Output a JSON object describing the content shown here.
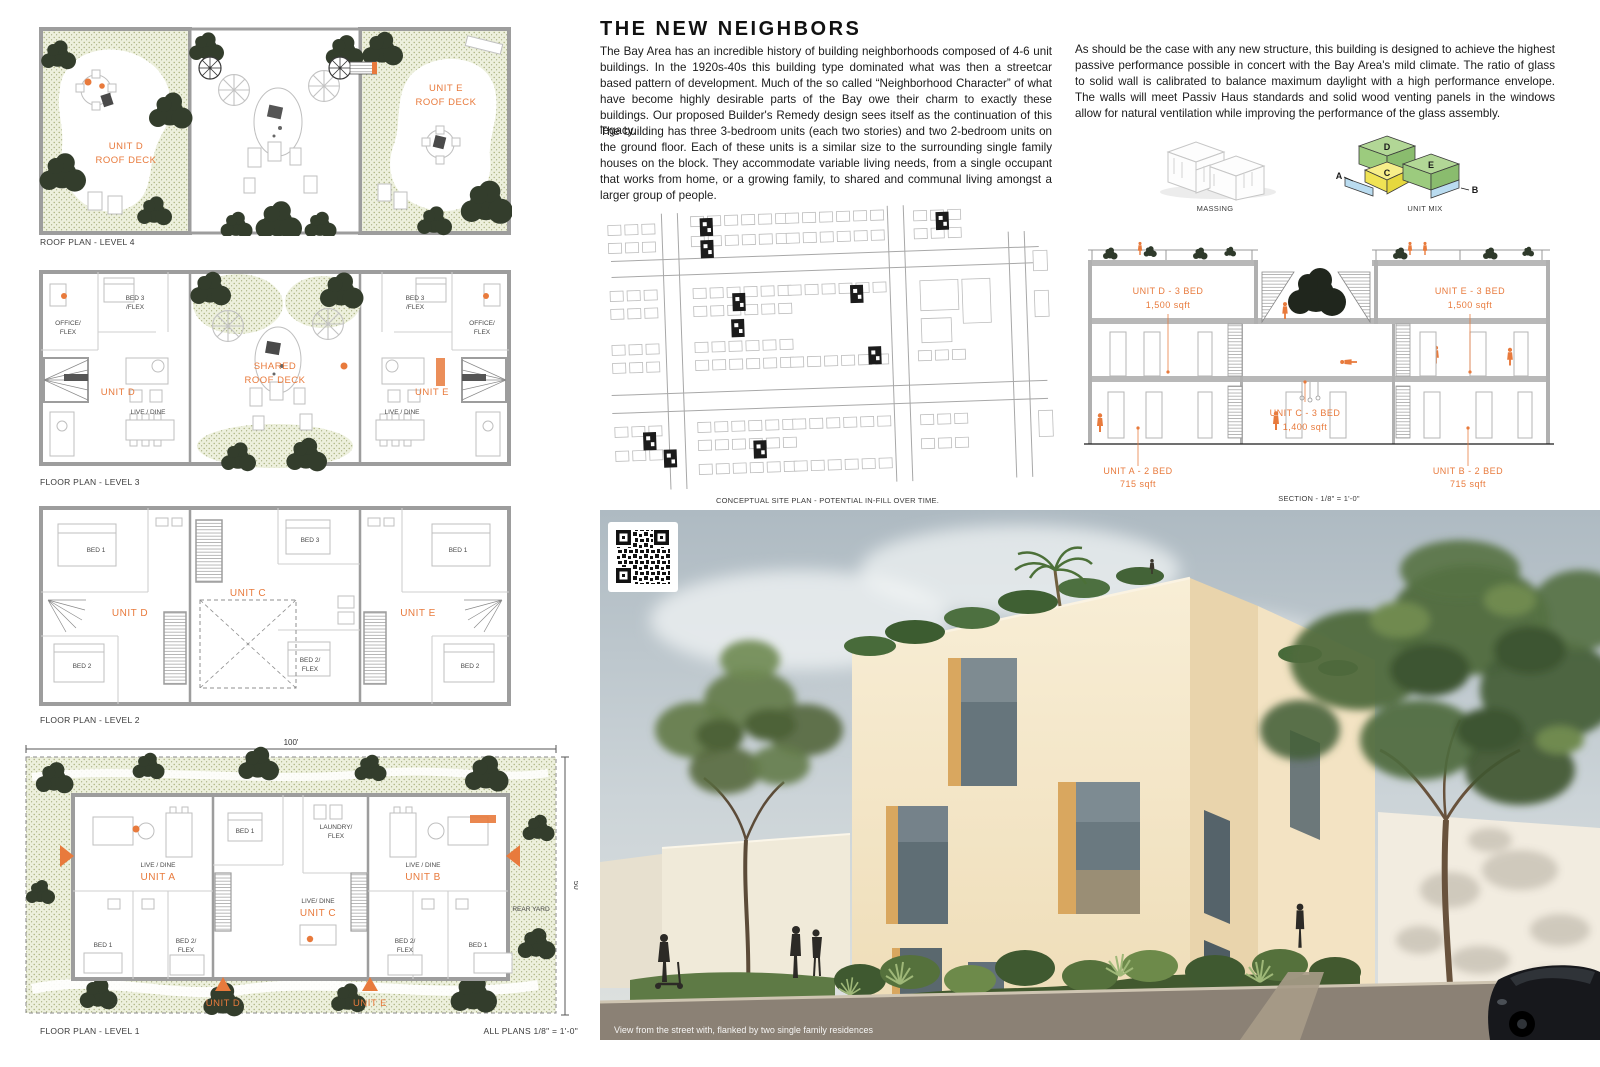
{
  "accent": "#E87A3C",
  "title": "THE NEW NEIGHBORS",
  "intro": {
    "p1": "The Bay Area has an incredible history of building neighborhoods composed of 4-6 unit buildings. In the 1920s-40s this building type dominated what was then a streetcar based pattern of development. Much of the so called “Neighborhood Character” of what have become highly desirable parts of the Bay owe their charm to exactly these buildings. Our proposed Builder's Remedy design sees itself as the continuation of this legacy.",
    "p2": "The building has three 3-bedroom units (each two stories) and two 2-bedroom units on the ground floor. Each of these units is a similar size to the surrounding single family houses on the block. They accommodate variable living needs, from a single occupant that works from home, or a growing family, to shared and communal living amongst a larger group of people."
  },
  "passive": {
    "p1": "As should be the case with any new structure, this building is designed to achieve the highest passive performance possible in concert with the Bay Area's mild climate. The ratio of glass to solid wall is calibrated to balance maximum daylight with a high performance envelope. The walls will meet Passiv Haus standards and solid wood venting panels in the windows allow for natural ventilation while improving the performance of the glass assembly."
  },
  "diagrams": {
    "massing_label": "MASSING",
    "unit_mix_label": "UNIT MIX",
    "letters": {
      "a": "A",
      "b": "B",
      "c": "C",
      "d": "D",
      "e": "E"
    },
    "colors": {
      "three_bed": "#A8D08D",
      "flex": "#F5E86C",
      "two_bed": "#BCDCEF"
    }
  },
  "site_plan": {
    "caption": "CONCEPTUAL SITE PLAN - POTENTIAL IN-FILL OVER TIME."
  },
  "section": {
    "caption": "SECTION - 1/8\" = 1'-0\"",
    "unit_d": {
      "name": "UNIT D - 3 BED",
      "area": "1,500 sqft"
    },
    "unit_e": {
      "name": "UNIT E - 3 BED",
      "area": "1,500 sqft"
    },
    "unit_c": {
      "name": "UNIT C - 3 BED",
      "area": "1,400 sqft"
    },
    "unit_a": {
      "name": "UNIT A - 2 BED",
      "area": "715 sqft"
    },
    "unit_b": {
      "name": "UNIT B - 2 BED",
      "area": "715 sqft"
    }
  },
  "plans": {
    "roof": {
      "caption": "ROOF PLAN - LEVEL 4",
      "unit_d_1": "UNIT D",
      "unit_d_2": "ROOF DECK",
      "unit_e_1": "UNIT E",
      "unit_e_2": "ROOF DECK"
    },
    "level3": {
      "caption": "FLOOR PLAN - LEVEL 3",
      "office_1": "OFFICE/",
      "office_2": "FLEX",
      "bed3_1": "BED 3",
      "bed3_2": "/FLEX",
      "shared_1": "SHARED",
      "shared_2": "ROOF DECK",
      "unit_d": "UNIT D",
      "unit_e": "UNIT E",
      "live_dine": "LIVE / DINE"
    },
    "level2": {
      "caption": "FLOOR PLAN - LEVEL 2",
      "bed1": "BED 1",
      "bed2": "BED 2",
      "bed3": "BED 3",
      "bed2flex_1": "BED 2/",
      "bed2flex_2": "FLEX",
      "unit_c": "UNIT C",
      "unit_d": "UNIT D",
      "unit_e": "UNIT E"
    },
    "level1": {
      "caption": "FLOOR PLAN - LEVEL 1",
      "scale_note": "ALL PLANS 1/8\" = 1'-0\"",
      "dim_width": "100'",
      "dim_depth": "50'",
      "live_dine": "LIVE / DINE",
      "live_dine_c": "LIVE/ DINE",
      "unit_a": "UNIT A",
      "unit_b": "UNIT B",
      "unit_c": "UNIT C",
      "unit_d": "UNIT D",
      "unit_e": "UNIT E",
      "bed1": "BED 1",
      "bed2flex_1": "BED 2/",
      "bed2flex_2": "FLEX",
      "laundry_1": "LAUNDRY/",
      "laundry_2": "FLEX",
      "rear_yard": "REAR YARD"
    }
  },
  "render": {
    "caption": "View from the street with, flanked by two single family residences"
  }
}
